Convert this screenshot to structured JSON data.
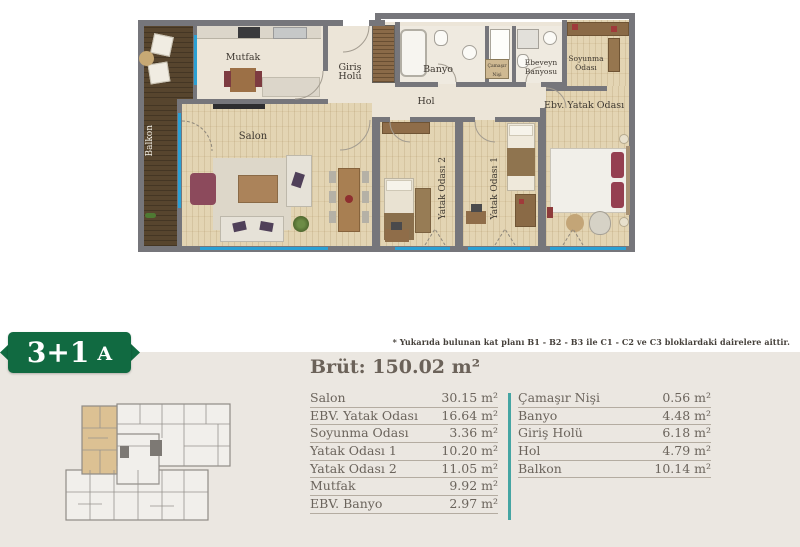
{
  "note": "* Yukarıda bulunan kat planı B1 - B2 - B3 ile C1 - C2 ve C3 bloklardaki dairelere aittir.",
  "badge": {
    "size": "3+1",
    "block": "A"
  },
  "summary_title": "Brüt: 150.02 m²",
  "area_table": {
    "left": [
      {
        "name": "Salon",
        "value": "30.15 m²"
      },
      {
        "name": "EBV. Yatak Odası",
        "value": "16.64 m²"
      },
      {
        "name": "Soyunma Odası",
        "value": "3.36 m²"
      },
      {
        "name": "Yatak Odası 1",
        "value": "10.20 m²"
      },
      {
        "name": "Yatak Odası 2",
        "value": "11.05 m²"
      },
      {
        "name": "Mutfak",
        "value": "9.92 m²"
      },
      {
        "name": "EBV. Banyo",
        "value": "2.97 m²"
      }
    ],
    "right": [
      {
        "name": "Çamaşır Nişi",
        "value": "0.56 m²"
      },
      {
        "name": "Banyo",
        "value": "4.48 m²"
      },
      {
        "name": "Giriş Holü",
        "value": "6.18 m²"
      },
      {
        "name": "Hol",
        "value": "4.79 m²"
      },
      {
        "name": "Balkon",
        "value": "10.14 m²"
      }
    ]
  },
  "floor_plan": {
    "labels": {
      "balkon": "Balkon",
      "mutfak": "Mutfak",
      "giris_holu": "Giriş Holü",
      "banyo": "Banyo",
      "camasir_nisi": "Çamaşır Nişi",
      "ebeveyn_banyosu": "Ebeveyn Banyosu",
      "soyunma_odasi": "Soyunma Odası",
      "hol": "Hol",
      "ebv_yatak_odasi": "Ebv. Yatak Odası",
      "salon": "Salon",
      "yatak_odasi_2": "Yatak Odası 2",
      "yatak_odasi_1": "Yatak Odası 1"
    }
  },
  "colors": {
    "badge_green": "#116a41",
    "divider_teal": "#45a5a3",
    "window_blue": "#2aa0d4",
    "highlight_tan": "#dcc193",
    "panel_bg": "#ebe7e1",
    "text_gray": "#6b645c"
  }
}
